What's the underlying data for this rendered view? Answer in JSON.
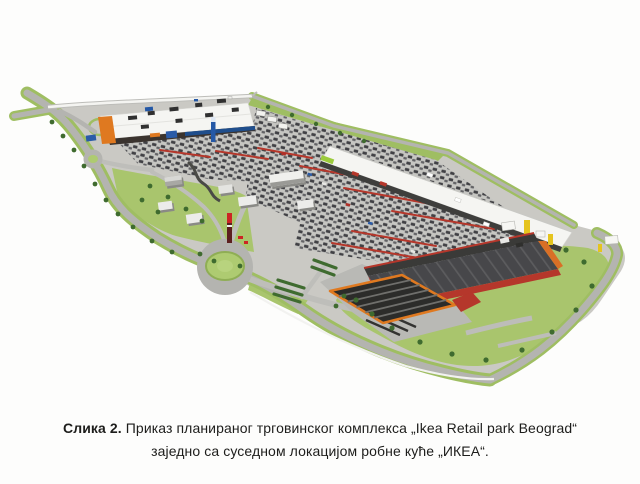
{
  "figure": {
    "caption": {
      "label": "Слика 2.",
      "line1": "Приказ планираног трговинског комплекса „Ikea Retail park Beograd“",
      "line2": "заједно са суседном локацијом робне куће „ИКЕА“."
    }
  },
  "colors": {
    "page_bg": "#fdfdfc",
    "ground": "#cac9c4",
    "road": "#b4b4b0",
    "road_light": "#bebeba",
    "green": "#9fbe62",
    "green_light": "#a9c56d",
    "green_dark": "#3f6b2f",
    "roof_white": "#f5f5f2",
    "facade_dark": "#3a332e",
    "strip_dark": "#3e3e3c",
    "ikea_roof": "#47474a",
    "red": "#b5372b",
    "orange": "#df7920",
    "yellow": "#e5c41e",
    "blue": "#2458a6",
    "blue_dark": "#1f4e8c",
    "caption_text": "#1d1d1b"
  }
}
